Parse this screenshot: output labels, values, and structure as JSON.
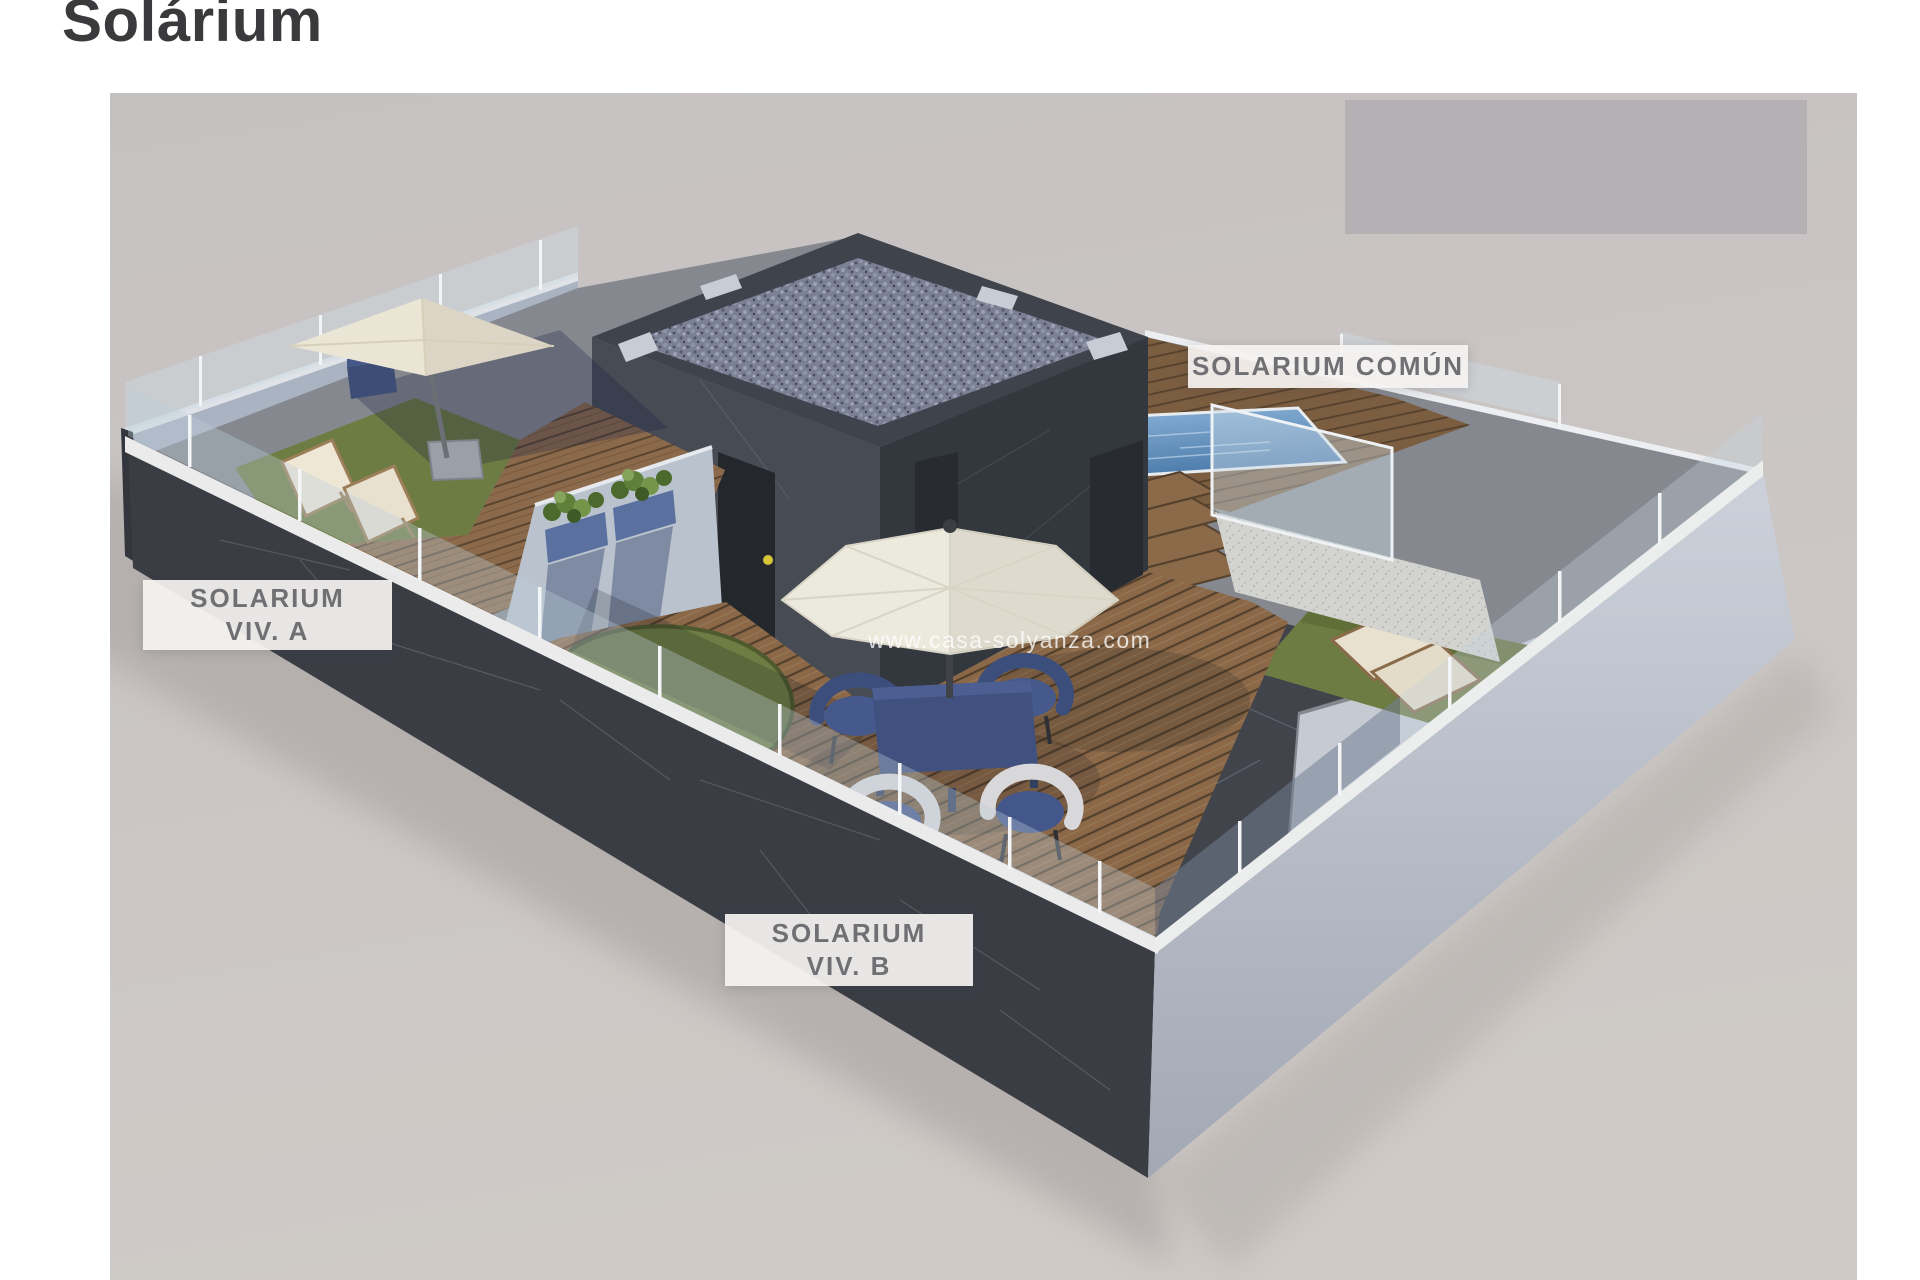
{
  "page": {
    "title": "Solárium"
  },
  "scene": {
    "labels": {
      "viv_a": {
        "line1": "SOLARIUM",
        "line2": "VIV. A"
      },
      "viv_b": {
        "line1": "SOLARIUM",
        "line2": "VIV. B"
      },
      "comun": {
        "text": "SOLARIUM COMÚN"
      }
    },
    "watermark": "www.casa-solyanza.com",
    "colors": {
      "page_background": "#ffffff",
      "canvas_floor": "#c9c4c3",
      "top_right_panel": "#b5b0b3",
      "dark_marble_wall": "#3a3d44",
      "light_wall": "#aab4c2",
      "white_wall_cap": "#ebebec",
      "glass": "#c8d7e2",
      "grass": "#6d7c42",
      "wood_deck": "#8a6848",
      "pool_water": "#6596c2",
      "gravel_roof": "#7c8095",
      "umbrella_cream": "#ebe5d5",
      "umbrella_white": "#ece9dd",
      "furniture_navy": "#3e4f7c",
      "wicker_white": "#d8d8da",
      "door_yellow_handle": "#d9c33c",
      "label_background": "#f4f2f0",
      "label_text": "#707074",
      "title_text": "#3a3a3c"
    }
  }
}
